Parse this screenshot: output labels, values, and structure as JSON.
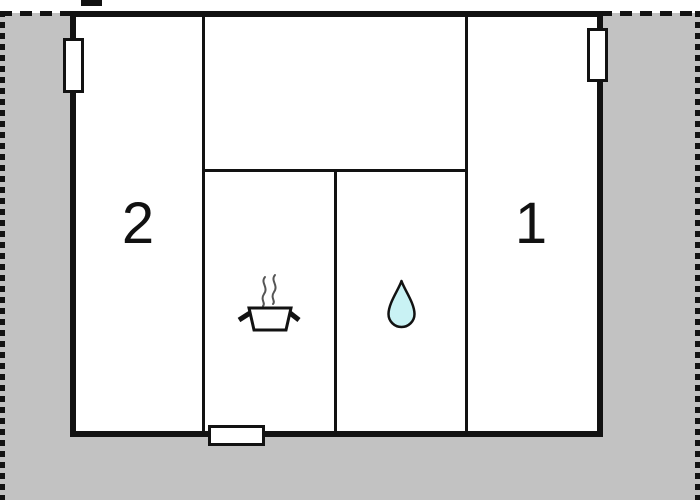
{
  "floorplan": {
    "room_labels": {
      "left_room": "2",
      "right_room": "1"
    },
    "icons": [
      {
        "name": "cooking-pot-icon"
      },
      {
        "name": "water-drop-icon"
      }
    ],
    "features": [
      "chimney",
      "window-left",
      "window-right",
      "entrance-door",
      "plot-boundary-dashed"
    ],
    "colors": {
      "ground": "#c2c2c2",
      "wall": "#121212",
      "window_fill": "#ffffff",
      "drop_fill": "#c9f2f4",
      "steam": "#555555",
      "background": "#ffffff"
    }
  }
}
